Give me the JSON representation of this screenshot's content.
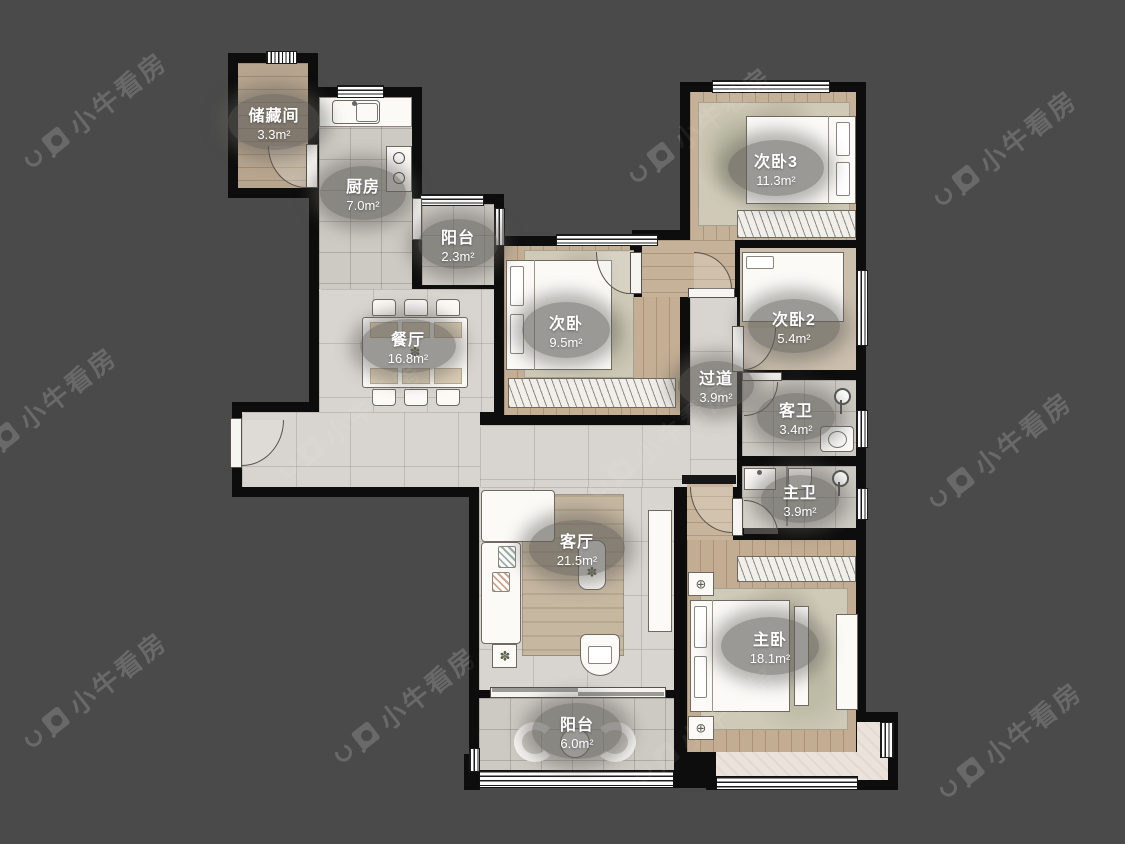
{
  "watermark": {
    "text": "小牛看房"
  },
  "rooms": [
    {
      "name": "储藏间",
      "area": "3.3m²"
    },
    {
      "name": "厨房",
      "area": "7.0m²"
    },
    {
      "name": "阳台",
      "area": "2.3m²"
    },
    {
      "name": "次卧",
      "area": "9.5m²"
    },
    {
      "name": "次卧3",
      "area": "11.3m²"
    },
    {
      "name": "次卧2",
      "area": "5.4m²"
    },
    {
      "name": "过道",
      "area": "3.9m²"
    },
    {
      "name": "客卫",
      "area": "3.4m²"
    },
    {
      "name": "主卫",
      "area": "3.9m²"
    },
    {
      "name": "餐厅",
      "area": "16.8m²"
    },
    {
      "name": "客厅",
      "area": "21.5m²"
    },
    {
      "name": "主卧",
      "area": "18.1m²"
    },
    {
      "name": "阳台",
      "area": "6.0m²"
    }
  ],
  "colors": {
    "background": "#4a4a4a",
    "wall": "#0d0d0d",
    "marble_floor": "#d8d5d0",
    "tile_floor": "#cdcac4",
    "wood_floor": "#bfa98d",
    "label_bubble": "#605e58",
    "watermark": "#606060"
  }
}
